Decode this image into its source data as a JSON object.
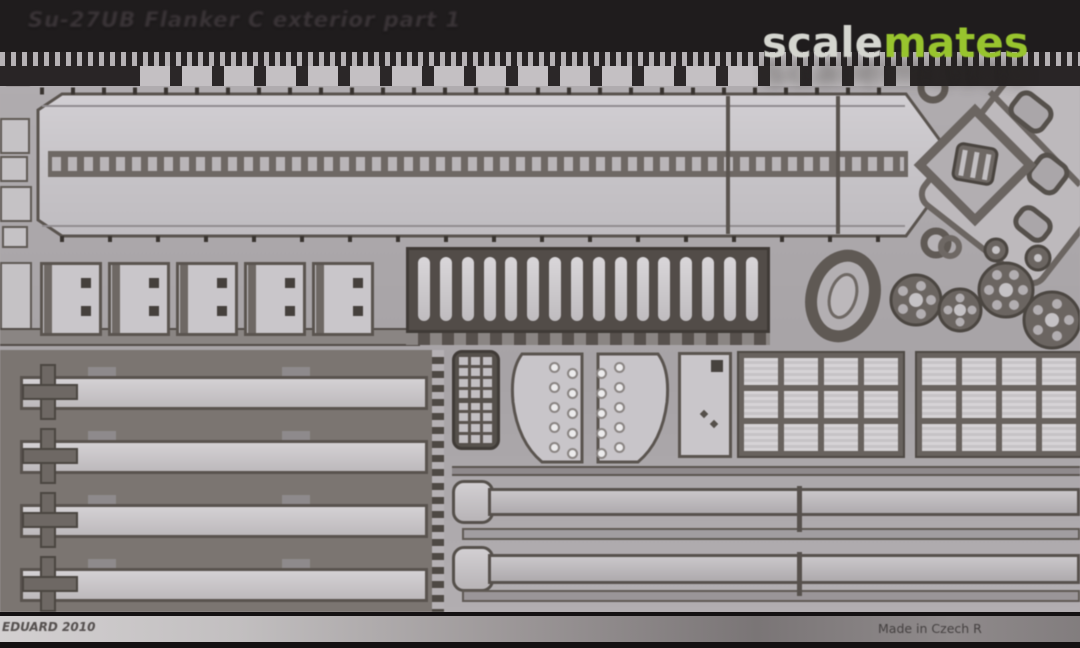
{
  "photo": {
    "embossed_title": "Su-27UB Flanker C exterior part 1",
    "watermark": {
      "gray_part": "scale",
      "green_part": "mates"
    },
    "footer": {
      "maker_text": "EDUARD 2010",
      "origin_text": "Made in Czech R"
    },
    "colors": {
      "top_band": "#1f1c1d",
      "footer_band": "#141112",
      "plate_background": "#b0acaf",
      "metal_light": "#c9c6ca",
      "metal_mid": "#a8a4a7",
      "metal_dark": "#5a544f",
      "watermark_gray": "#d4d5cf",
      "watermark_green": "#98c42e"
    },
    "fret": {
      "grille_slot_count": 16,
      "hinge_plate_count": 5,
      "plate_hole_count": 2,
      "left_strip_count": 4,
      "grid_panel_cell_count": 12,
      "fan_hole_count": 5
    }
  }
}
